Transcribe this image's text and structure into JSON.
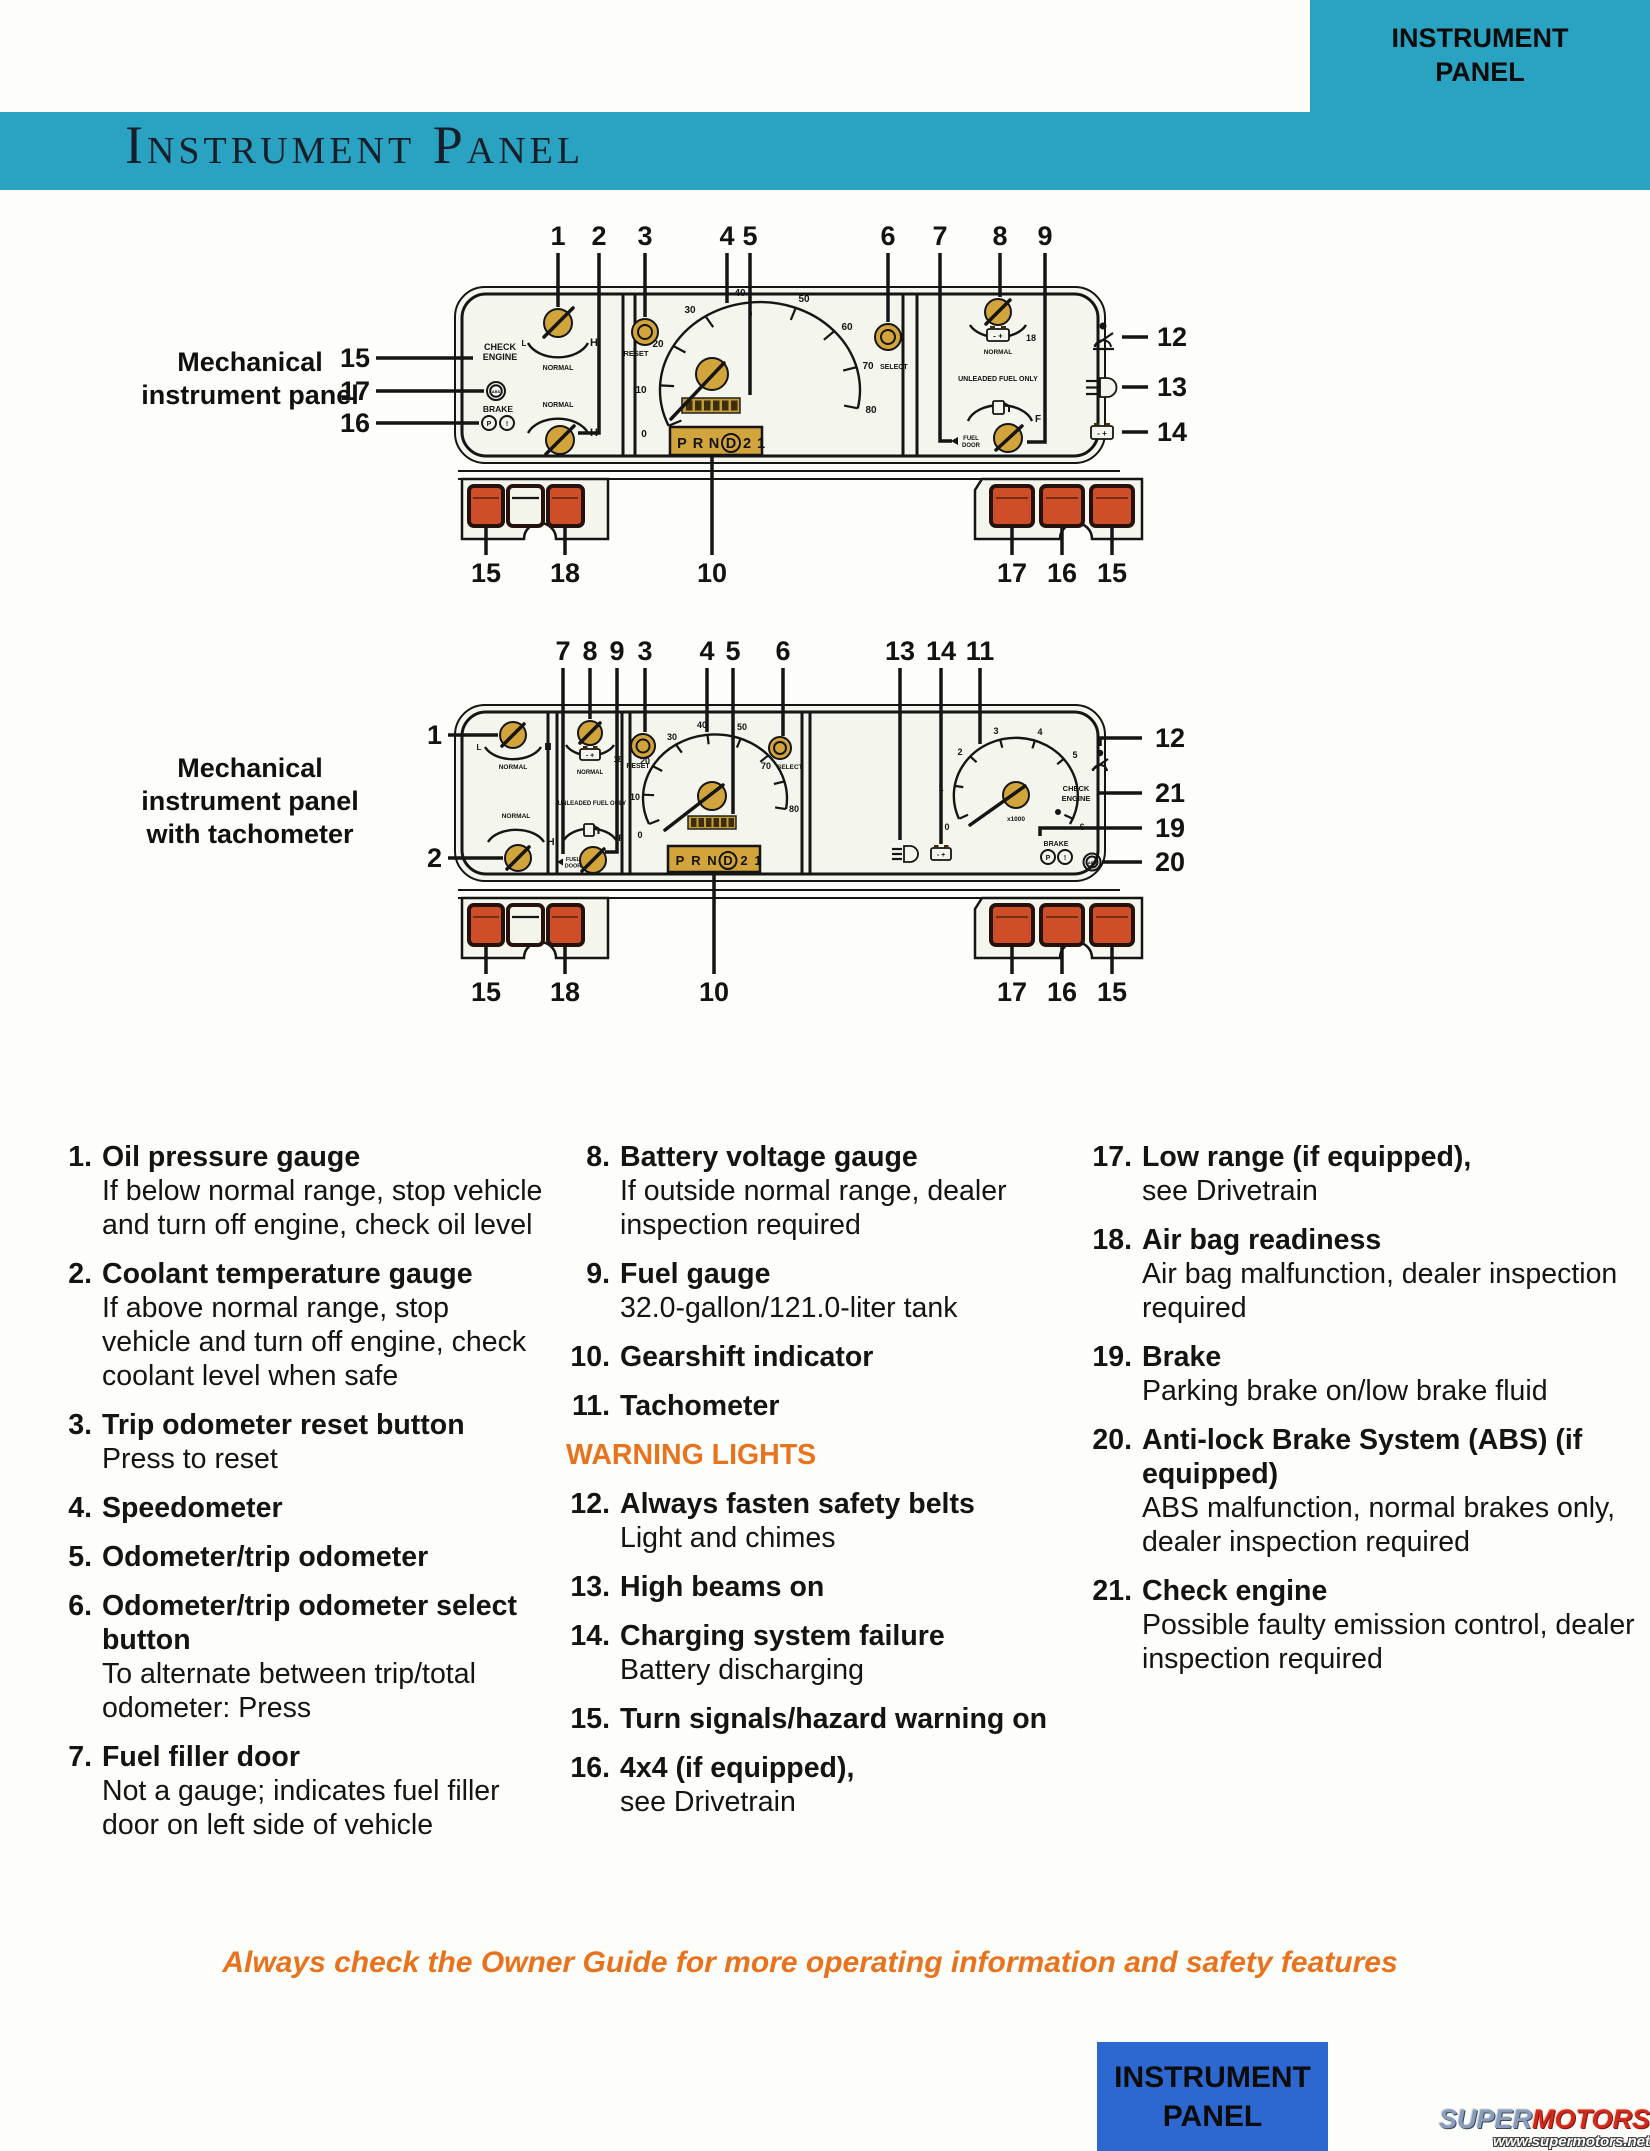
{
  "page": {
    "corner_tab": {
      "line1": "INSTRUMENT",
      "line2": "PANEL"
    },
    "banner_title": "Instrument Panel",
    "footer_note": "Always check the Owner Guide for more operating information and safety features",
    "bottom_tab": {
      "line1": "INSTRUMENT",
      "line2": "PANEL"
    },
    "watermark": {
      "super": "SUPER",
      "motors": "MOTORS",
      "url": "www.supermotors.net"
    }
  },
  "colors": {
    "teal_banner": "#2aa3c2",
    "blue_tab": "#2c68cf",
    "orange_accent": "#e8731e",
    "gauge_gold": "#d2a43c",
    "warning_light_red": "#ce4e28",
    "panel_bg": "#f4f5ec"
  },
  "diagram1": {
    "label": "Mechanical instrument panel",
    "top_callouts": [
      "1",
      "2",
      "3",
      "4",
      "5",
      "6",
      "7",
      "8",
      "9"
    ],
    "left_callouts": [
      "15",
      "17",
      "16"
    ],
    "right_callouts": [
      "12",
      "13",
      "14"
    ],
    "bottom_callouts": [
      "15",
      "18",
      "10",
      "17",
      "16",
      "15"
    ]
  },
  "diagram2": {
    "label": "Mechanical instrument panel with tachometer",
    "top_callouts": [
      "7",
      "8",
      "9",
      "3",
      "4",
      "5",
      "6",
      "13",
      "14",
      "11"
    ],
    "left_callouts": [
      "1",
      "2"
    ],
    "right_callouts": [
      "12",
      "21",
      "19",
      "20"
    ],
    "bottom_callouts": [
      "15",
      "18",
      "10",
      "17",
      "16",
      "15"
    ]
  },
  "cluster": {
    "check": "CHECK",
    "engine": "ENGINE",
    "brake": "BRAKE",
    "abs": "ABS",
    "p": "P",
    "excl": "!",
    "reset": "RESET",
    "select": "SELECT",
    "normal": "NORMAL",
    "l": "L",
    "h": "H",
    "f": "F",
    "minus_plus": "- +",
    "v18": "18",
    "unleaded": "UNLEADED FUEL ONLY",
    "fuel": "FUEL",
    "door": "DOOR",
    "x1000": "x1000",
    "speedo": [
      "0",
      "10",
      "20",
      "30",
      "40",
      "50",
      "60",
      "70",
      "80"
    ],
    "tach": [
      "0",
      "1",
      "2",
      "3",
      "4",
      "5",
      "6"
    ],
    "prnd": [
      "P",
      "R",
      "N",
      "D",
      "2",
      "1"
    ]
  },
  "legend": {
    "col1": [
      {
        "num": "1.",
        "title": "Oil pressure gauge",
        "desc": "If below normal range, stop vehicle and turn off engine, check oil level"
      },
      {
        "num": "2.",
        "title": "Coolant temperature gauge",
        "desc": "If above normal range, stop vehicle and turn off engine, check coolant level when safe"
      },
      {
        "num": "3.",
        "title": "Trip odometer reset button",
        "desc": "Press to reset"
      },
      {
        "num": "4.",
        "title": "Speedometer"
      },
      {
        "num": "5.",
        "title": "Odometer/trip odometer"
      },
      {
        "num": "6.",
        "title": "Odometer/trip odometer select button",
        "desc": "To alternate between trip/total odometer: Press"
      },
      {
        "num": "7.",
        "title": "Fuel filler door",
        "desc": "Not a gauge; indicates fuel filler door on left side of vehicle"
      }
    ],
    "col2": [
      {
        "num": "8.",
        "title": "Battery voltage gauge",
        "desc": "If outside normal range, dealer inspection required"
      },
      {
        "num": "9.",
        "title": "Fuel gauge",
        "desc": "32.0-gallon/121.0-liter tank"
      },
      {
        "num": "10.",
        "title": "Gearshift indicator"
      },
      {
        "num": "11.",
        "title": "Tachometer"
      },
      {
        "header": true,
        "title": "WARNING LIGHTS"
      },
      {
        "num": "12.",
        "title": "Always fasten safety belts",
        "desc": "Light and chimes"
      },
      {
        "num": "13.",
        "title": "High beams on"
      },
      {
        "num": "14.",
        "title": "Charging system failure",
        "desc": "Battery discharging"
      },
      {
        "num": "15.",
        "title": "Turn signals/hazard warning on"
      },
      {
        "num": "16.",
        "title": "4x4 (if equipped),",
        "desc": "see Drivetrain"
      }
    ],
    "col3": [
      {
        "num": "17.",
        "title": "Low range (if equipped),",
        "desc": "see Drivetrain"
      },
      {
        "num": "18.",
        "title": "Air bag readiness",
        "desc": "Air bag malfunction, dealer inspection required"
      },
      {
        "num": "19.",
        "title": "Brake",
        "desc": "Parking brake on/low brake fluid"
      },
      {
        "num": "20.",
        "title": "Anti-lock Brake System (ABS) (if equipped)",
        "desc": "ABS malfunction, normal brakes only, dealer inspection required"
      },
      {
        "num": "21.",
        "title": "Check engine",
        "desc": "Possible faulty emission control, dealer inspection required"
      }
    ]
  }
}
